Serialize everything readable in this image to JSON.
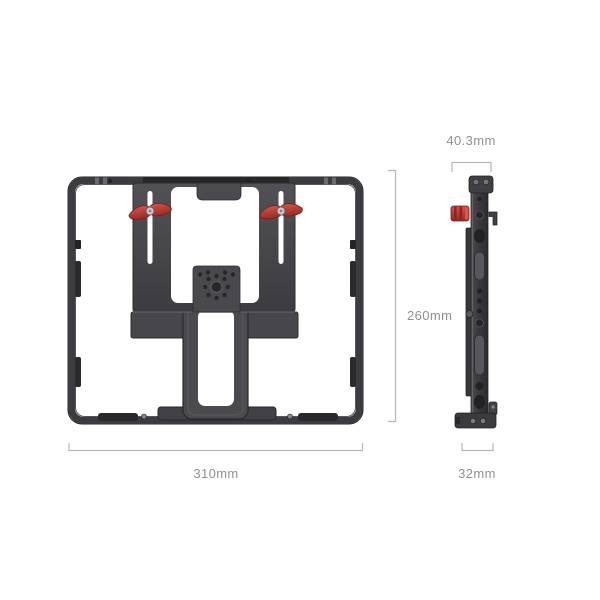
{
  "diagram": {
    "type": "product-dimension-diagram",
    "views": {
      "front": {
        "name": "tablet-cage-front-view"
      },
      "side": {
        "name": "tablet-cage-side-profile-view"
      }
    },
    "dimensions": {
      "front_width": "310mm",
      "front_height": "260mm",
      "side_top_width": "40.3mm",
      "side_bottom_width": "32mm"
    },
    "colors": {
      "background": "#ffffff",
      "cage_body_dark": "#3e3e42",
      "cage_body_light": "#55555a",
      "cutout_white": "#ffffff",
      "accent_red": "#bc3a31",
      "screw_silver": "#9a9aa0",
      "dimension_line": "#b5b8b9",
      "dimension_text": "#8e9192"
    },
    "icons": {
      "lever_left": "red-thumbscrew-lever-icon",
      "lever_right": "red-thumbscrew-lever-icon",
      "knob_side": "red-knob-icon"
    }
  }
}
